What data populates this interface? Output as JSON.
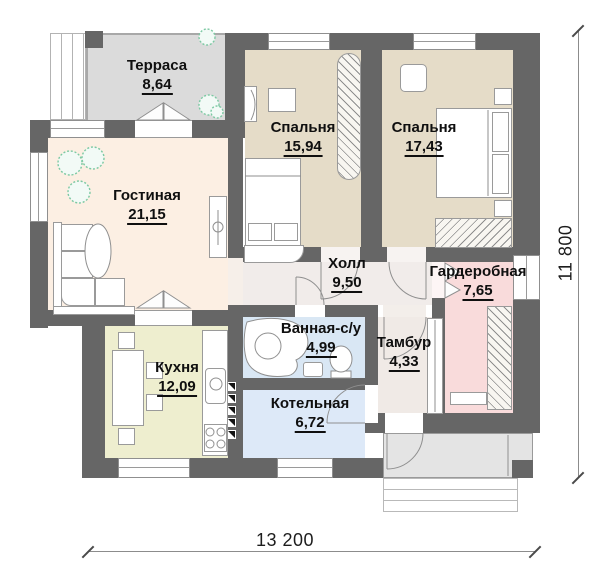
{
  "plan": {
    "title": "Floor plan of a one-storey house",
    "rooms": {
      "terrasa": {
        "name": "Терраса",
        "area": "8,64"
      },
      "spalnya1": {
        "name": "Спальня",
        "area": "15,94"
      },
      "spalnya2": {
        "name": "Спальня",
        "area": "17,43"
      },
      "gostinaya": {
        "name": "Гостиная",
        "area": "21,15"
      },
      "holl": {
        "name": "Холл",
        "area": "9,50"
      },
      "garderobnaya": {
        "name": "Гардеробная",
        "area": "7,65"
      },
      "vannaya": {
        "name": "Ванная-с/у",
        "area": "4,99"
      },
      "tambur": {
        "name": "Тамбур",
        "area": "4,33"
      },
      "kuhnya": {
        "name": "Кухня",
        "area": "12,09"
      },
      "kotelnaya": {
        "name": "Котельная",
        "area": "6,72"
      }
    },
    "dimensions": {
      "width_mm": "13 200",
      "height_mm": "11 800"
    },
    "colors": {
      "wall": "#666666",
      "terrace": "#dbdbdb",
      "living": "#fcefe3",
      "bedroom": "#e5dcc8",
      "hall": "#f1ecea",
      "wardrobe_room": "#f9dbdb",
      "bathroom": "#d9e7f4",
      "vestibule": "#f0eae6",
      "kitchen": "#eeeecf",
      "boiler": "#dde9f8",
      "porch": "#e4e4e4",
      "plant": "#7cc9a3"
    }
  }
}
